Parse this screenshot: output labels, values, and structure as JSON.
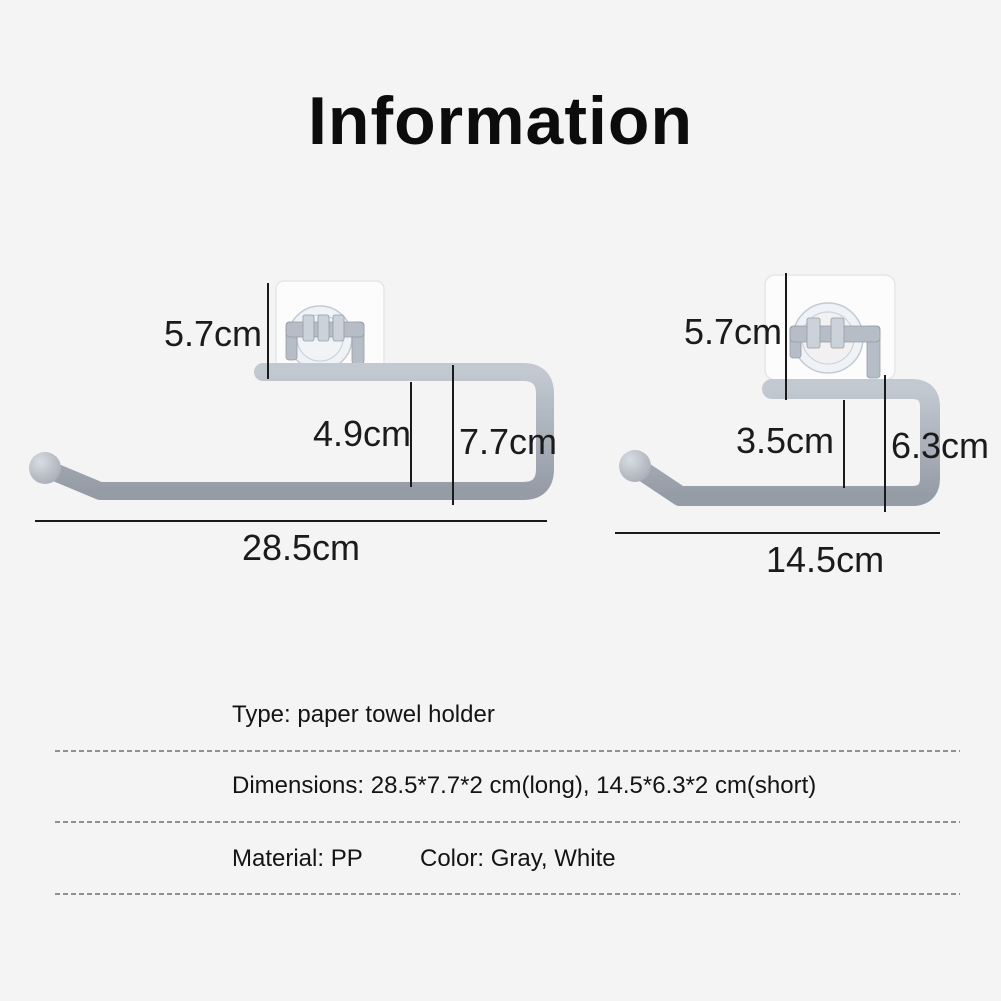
{
  "title": "Information",
  "products": {
    "long": {
      "label_top_height": "5.7cm",
      "label_inner_height": "4.9cm",
      "label_side_height": "7.7cm",
      "label_width": "28.5cm"
    },
    "short": {
      "label_top_height": "5.7cm",
      "label_inner_height": "3.5cm",
      "label_side_height": "6.3cm",
      "label_width": "14.5cm"
    }
  },
  "specs": {
    "type_line": "Type: paper towel holder",
    "dimensions_line": "Dimensions: 28.5*7.7*2 cm(long), 14.5*6.3*2 cm(short)",
    "material_label": "Material: PP",
    "color_label": "Color: Gray, White"
  },
  "colors": {
    "background": "#f4f4f5",
    "title_text": "#0c0c0c",
    "product_gray": "#aeb4bd",
    "pad_white": "#fcfcfd",
    "dimension_line": "#1a1a1a",
    "divider_dash": "#909090"
  }
}
